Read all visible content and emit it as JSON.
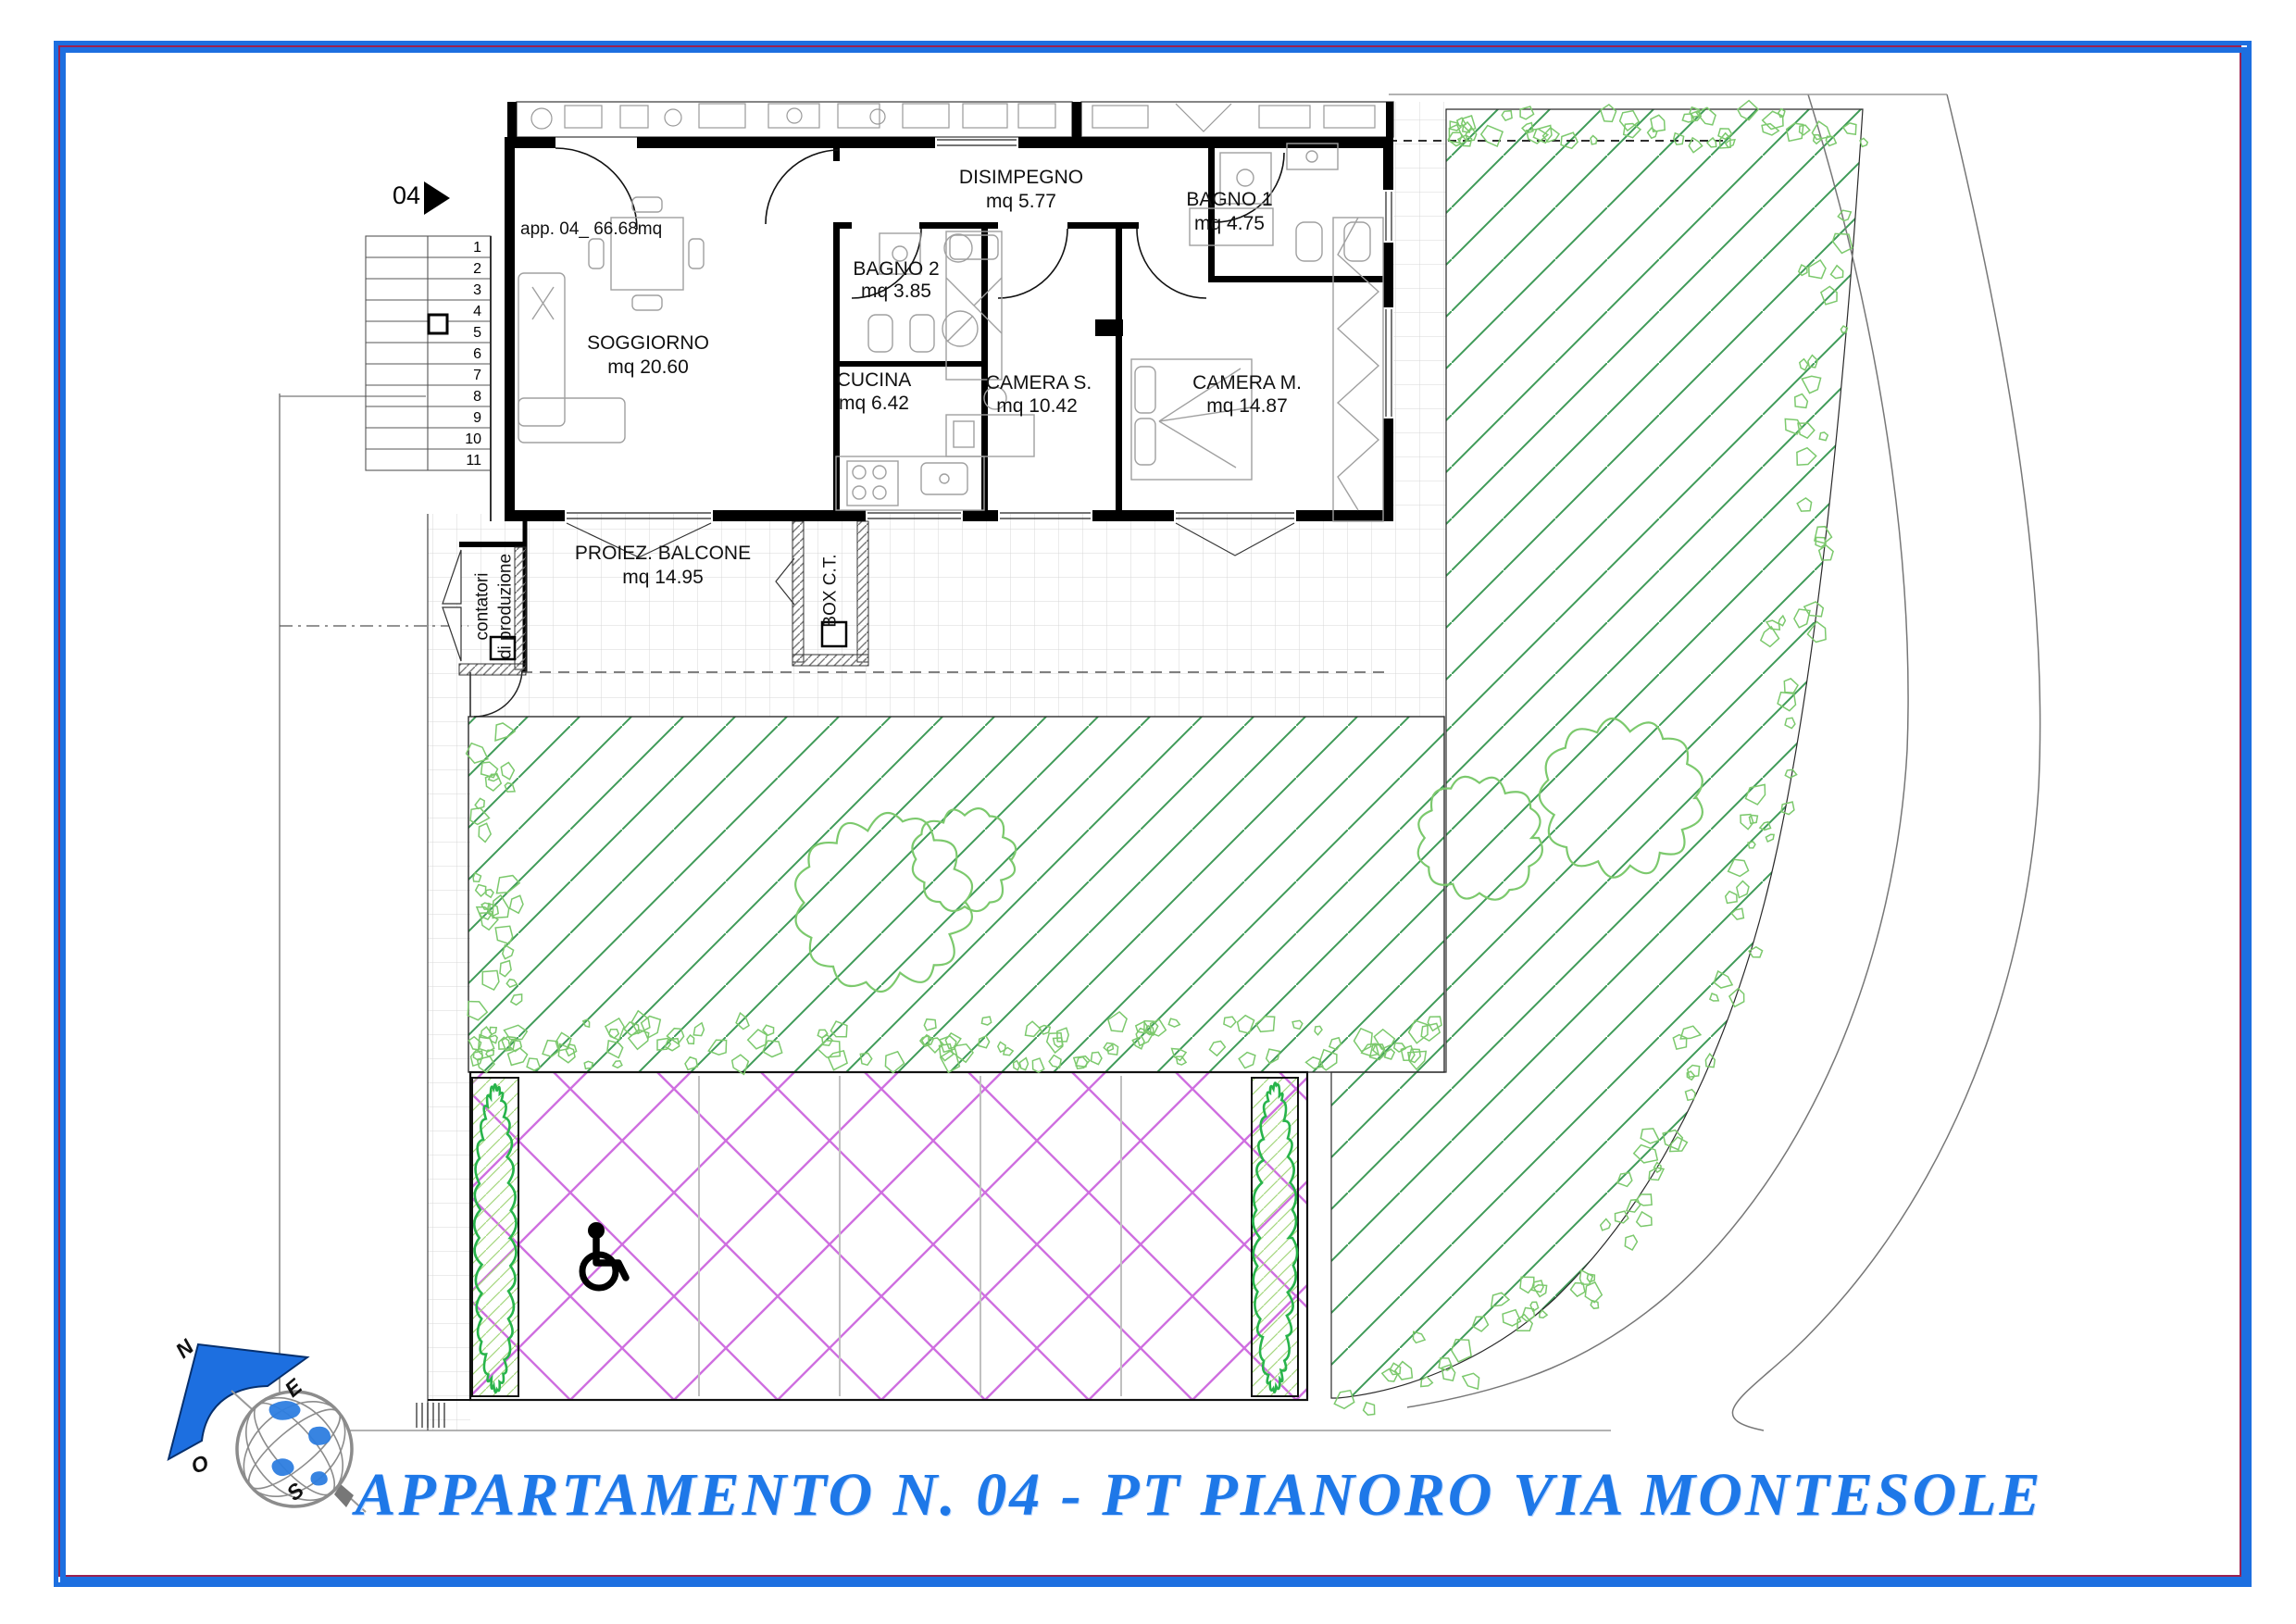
{
  "page_title": "APPARTAMENTO N. 04 - PT PIANORO VIA MONTESOLE",
  "unit": {
    "marker": "04",
    "area_label": "app. 04_ 66.68mq"
  },
  "rooms": {
    "soggiorno": {
      "name": "SOGGIORNO",
      "area": "mq 20.60"
    },
    "cucina": {
      "name": "CUCINA",
      "area": "mq 6.42"
    },
    "bagno2": {
      "name": "BAGNO 2",
      "area": "mq 3.85"
    },
    "disimpegno": {
      "name": "DISIMPEGNO",
      "area": "mq 5.77"
    },
    "bagno1": {
      "name": "BAGNO 1",
      "area": "mq 4.75"
    },
    "camera_s": {
      "name": "CAMERA S.",
      "area": "mq 10.42"
    },
    "camera_m": {
      "name": "CAMERA M.",
      "area": "mq 14.87"
    },
    "balcone": {
      "name": "PROIEZ. BALCONE",
      "area": "mq 14.95"
    }
  },
  "service": {
    "contatori_line1": "contatori",
    "contatori_line2": "di produzione",
    "box_ct": "BOX C.T."
  },
  "stairs": {
    "steps": [
      "1",
      "2",
      "3",
      "4",
      "5",
      "6",
      "7",
      "8",
      "9",
      "10",
      "11"
    ]
  },
  "compass": {
    "north": "N",
    "east": "E",
    "west": "O",
    "south": "S"
  },
  "colors": {
    "frame_blue": "#1d6fe0",
    "frame_accent_red": "#9b2150",
    "garden_green": "#3f9b58",
    "foliage_light_green": "#7cc96d",
    "hedge_green": "#28b44b",
    "hedge_fill_green": "#a5d67e",
    "parking_violet": "#cf6fe0",
    "paving_gray": "#d7d7d7",
    "title_blue": "#1e78e8",
    "furniture_gray": "#a0a0a0"
  }
}
